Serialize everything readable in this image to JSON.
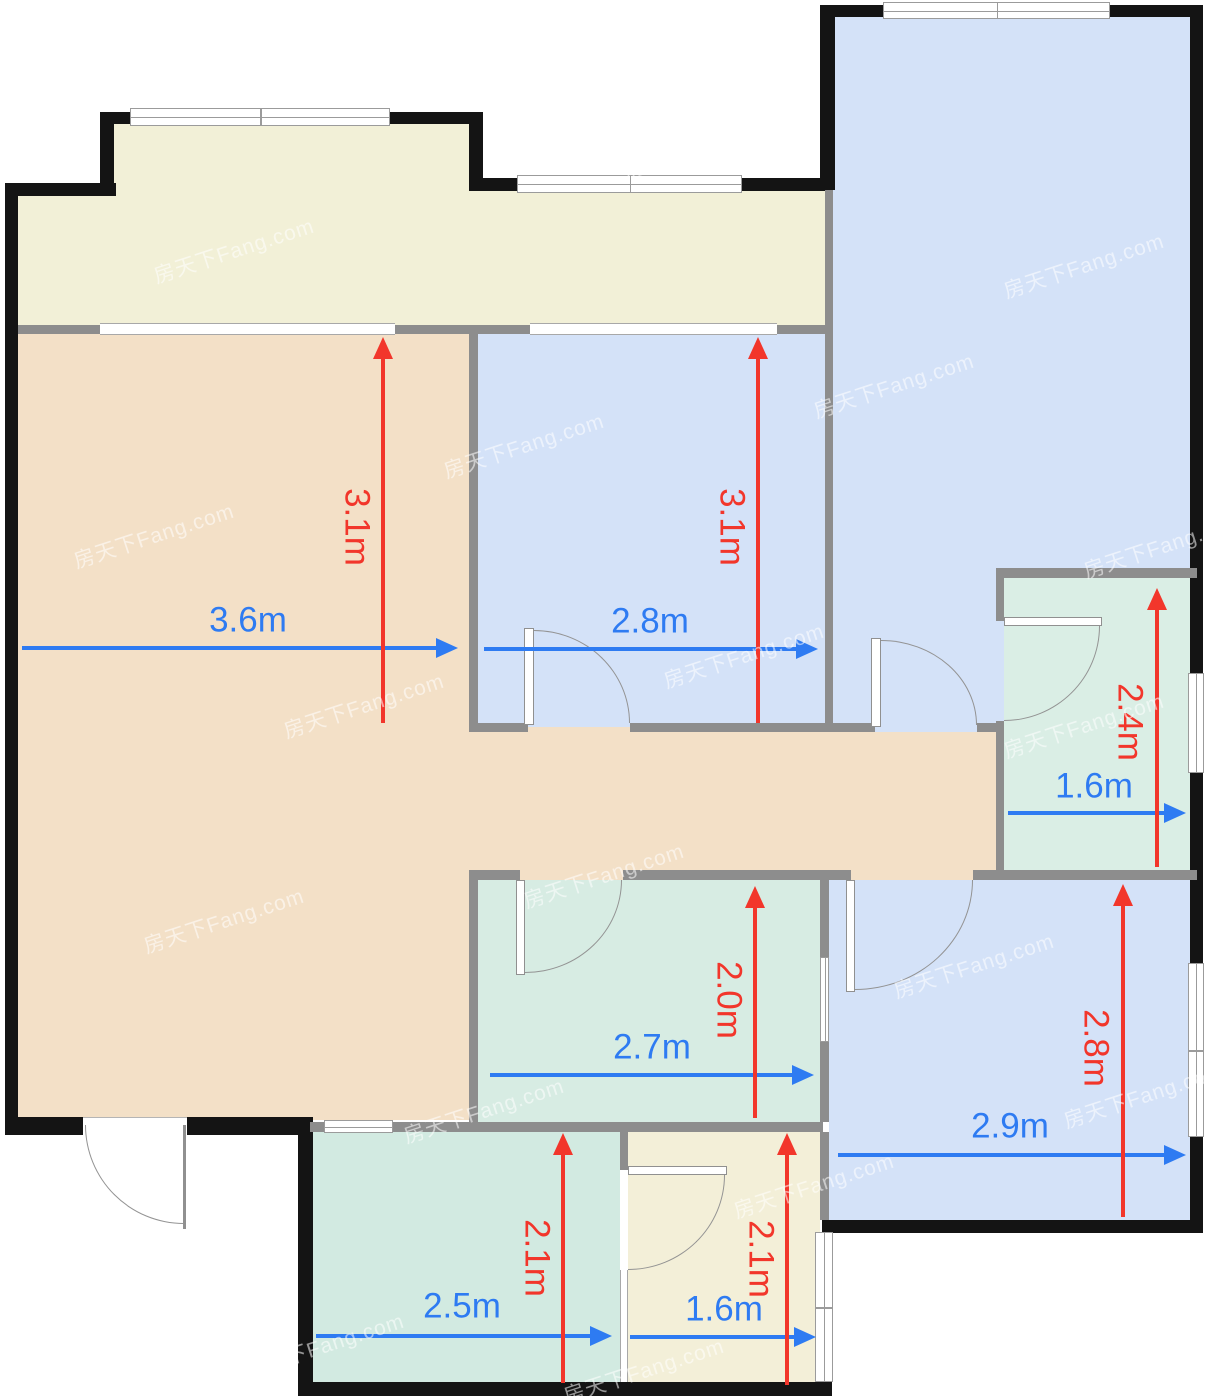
{
  "plan": {
    "canvas": {
      "width": 1208,
      "height": 1400
    },
    "colors": {
      "outer_wall": "#141414",
      "inner_wall": "#8d8d8d",
      "balcony": "#f2f0d7",
      "living": "#f3e0c7",
      "blue_room": "#d4e2f8",
      "green_room": "#d7ece3",
      "green_room_bottom": "#d2eae1",
      "bathroom_green": "#daeee5",
      "cream_room": "#f3efd8",
      "dim_red": "#f2362b",
      "dim_blue": "#2e7bf2"
    },
    "watermark": {
      "text": "房天下Fang.com"
    },
    "watermarks": [
      {
        "x": 150,
        "y": 235
      },
      {
        "x": 620,
        "y": 130
      },
      {
        "x": 1000,
        "y": 250
      },
      {
        "x": 70,
        "y": 520
      },
      {
        "x": 440,
        "y": 430
      },
      {
        "x": 810,
        "y": 370
      },
      {
        "x": 1080,
        "y": 530
      },
      {
        "x": 280,
        "y": 690
      },
      {
        "x": 660,
        "y": 640
      },
      {
        "x": 1000,
        "y": 710
      },
      {
        "x": 140,
        "y": 905
      },
      {
        "x": 520,
        "y": 860
      },
      {
        "x": 890,
        "y": 950
      },
      {
        "x": 1060,
        "y": 1080
      },
      {
        "x": 400,
        "y": 1095
      },
      {
        "x": 730,
        "y": 1170
      },
      {
        "x": 240,
        "y": 1330
      },
      {
        "x": 900,
        "y": 1320
      },
      {
        "x": 560,
        "y": 1355
      }
    ],
    "rooms": [
      {
        "name": "balcony-bump",
        "fill": "balcony",
        "x": 114,
        "y": 124,
        "w": 355,
        "h": 210
      },
      {
        "name": "balcony-main",
        "fill": "balcony",
        "x": 18,
        "y": 190,
        "w": 807,
        "h": 145
      },
      {
        "name": "living-room",
        "fill": "living",
        "x": 18,
        "y": 330,
        "w": 451,
        "h": 790
      },
      {
        "name": "corridor",
        "fill": "living",
        "x": 469,
        "y": 723,
        "w": 535,
        "h": 157
      },
      {
        "name": "bedroom-middle",
        "fill": "blue_room",
        "x": 478,
        "y": 334,
        "w": 347,
        "h": 393
      },
      {
        "name": "bedroom-large",
        "fill": "blue_room",
        "x": 833,
        "y": 17,
        "w": 357,
        "h": 715
      },
      {
        "name": "bathroom-right",
        "fill": "bathroom_green",
        "x": 1004,
        "y": 578,
        "w": 186,
        "h": 292
      },
      {
        "name": "room-green-middle",
        "fill": "green_room",
        "x": 478,
        "y": 880,
        "w": 342,
        "h": 242
      },
      {
        "name": "bedroom-bottom-right",
        "fill": "blue_room",
        "x": 829,
        "y": 880,
        "w": 361,
        "h": 340
      },
      {
        "name": "room-green-bottom",
        "fill": "green_room_bottom",
        "x": 313,
        "y": 1132,
        "w": 307,
        "h": 250
      },
      {
        "name": "bathroom-bottom",
        "fill": "cream_room",
        "x": 628,
        "y": 1132,
        "w": 192,
        "h": 250
      }
    ],
    "outer_walls": [
      {
        "x": 100,
        "y": 112,
        "w": 30,
        "h": 12
      },
      {
        "x": 390,
        "y": 112,
        "w": 93,
        "h": 12
      },
      {
        "x": 100,
        "y": 112,
        "w": 14,
        "h": 80
      },
      {
        "x": 469,
        "y": 112,
        "w": 14,
        "h": 78
      },
      {
        "x": 5,
        "y": 183,
        "w": 111,
        "h": 13
      },
      {
        "x": 469,
        "y": 178,
        "w": 48,
        "h": 13
      },
      {
        "x": 742,
        "y": 178,
        "w": 84,
        "h": 13
      },
      {
        "x": 5,
        "y": 183,
        "w": 13,
        "h": 952
      },
      {
        "x": 820,
        "y": 5,
        "w": 15,
        "h": 185
      },
      {
        "x": 820,
        "y": 5,
        "w": 63,
        "h": 12
      },
      {
        "x": 1110,
        "y": 5,
        "w": 93,
        "h": 12
      },
      {
        "x": 1190,
        "y": 5,
        "w": 13,
        "h": 555
      },
      {
        "x": 1190,
        "y": 560,
        "w": 13,
        "h": 113
      },
      {
        "x": 1190,
        "y": 773,
        "w": 13,
        "h": 190
      },
      {
        "x": 1190,
        "y": 1137,
        "w": 13,
        "h": 95
      },
      {
        "x": 822,
        "y": 1220,
        "w": 381,
        "h": 13
      },
      {
        "x": 298,
        "y": 1382,
        "w": 534,
        "h": 14
      },
      {
        "x": 298,
        "y": 1127,
        "w": 15,
        "h": 268
      },
      {
        "x": 5,
        "y": 1117,
        "w": 78,
        "h": 18
      },
      {
        "x": 187,
        "y": 1117,
        "w": 126,
        "h": 18
      }
    ],
    "inner_walls": [
      {
        "x": 18,
        "y": 325,
        "w": 82,
        "h": 9
      },
      {
        "x": 395,
        "y": 325,
        "w": 135,
        "h": 9
      },
      {
        "x": 777,
        "y": 325,
        "w": 48,
        "h": 9
      },
      {
        "x": 825,
        "y": 190,
        "w": 8,
        "h": 542
      },
      {
        "x": 469,
        "y": 334,
        "w": 9,
        "h": 389
      },
      {
        "x": 469,
        "y": 723,
        "w": 59,
        "h": 9
      },
      {
        "x": 630,
        "y": 723,
        "w": 195,
        "h": 9
      },
      {
        "x": 833,
        "y": 723,
        "w": 42,
        "h": 9
      },
      {
        "x": 977,
        "y": 723,
        "w": 27,
        "h": 9
      },
      {
        "x": 996,
        "y": 568,
        "w": 201,
        "h": 10
      },
      {
        "x": 996,
        "y": 578,
        "w": 8,
        "h": 43
      },
      {
        "x": 996,
        "y": 721,
        "w": 8,
        "h": 149
      },
      {
        "x": 469,
        "y": 870,
        "w": 51,
        "h": 10
      },
      {
        "x": 623,
        "y": 870,
        "w": 228,
        "h": 10
      },
      {
        "x": 973,
        "y": 870,
        "w": 224,
        "h": 10
      },
      {
        "x": 469,
        "y": 880,
        "w": 9,
        "h": 242
      },
      {
        "x": 820,
        "y": 880,
        "w": 9,
        "h": 77
      },
      {
        "x": 820,
        "y": 1042,
        "w": 9,
        "h": 80
      },
      {
        "x": 310,
        "y": 1122,
        "w": 14,
        "h": 10
      },
      {
        "x": 393,
        "y": 1122,
        "w": 76,
        "h": 10
      },
      {
        "x": 469,
        "y": 1122,
        "w": 354,
        "h": 10
      },
      {
        "x": 620,
        "y": 1132,
        "w": 8,
        "h": 38
      },
      {
        "x": 820,
        "y": 1132,
        "w": 9,
        "h": 88
      }
    ],
    "windows": [
      {
        "name": "balcony-bump-window",
        "x": 130,
        "y": 108,
        "w": 260,
        "h": 18,
        "orient": "h",
        "divider": true
      },
      {
        "name": "balcony-right-window",
        "x": 517,
        "y": 175,
        "w": 225,
        "h": 18,
        "orient": "h",
        "divider": true
      },
      {
        "name": "bedroom-large-top-window",
        "x": 883,
        "y": 2,
        "w": 227,
        "h": 17,
        "orient": "h",
        "divider": true
      },
      {
        "name": "bathroom-right-window",
        "x": 1188,
        "y": 673,
        "w": 16,
        "h": 100,
        "orient": "v",
        "divider": false
      },
      {
        "name": "bedroom-bottom-right-window",
        "x": 1188,
        "y": 963,
        "w": 16,
        "h": 174,
        "orient": "v",
        "divider": true
      },
      {
        "name": "bathroom-bottom-right-window",
        "x": 815,
        "y": 1232,
        "w": 18,
        "h": 150,
        "orient": "v",
        "divider": true
      },
      {
        "name": "room-green-bottom-window",
        "x": 324,
        "y": 1120,
        "w": 69,
        "h": 13,
        "orient": "h",
        "divider": false
      },
      {
        "name": "room-green-middle-window",
        "x": 820,
        "y": 957,
        "w": 9,
        "h": 85,
        "orient": "v",
        "divider": false
      }
    ],
    "openings": [
      {
        "name": "living-balcony-slider",
        "x": 100,
        "y": 323,
        "w": 295,
        "h": 12
      },
      {
        "name": "bedroom-balcony-slider",
        "x": 530,
        "y": 323,
        "w": 247,
        "h": 12
      },
      {
        "name": "bathroom-bottom-left-window",
        "x": 620,
        "y": 1270,
        "w": 8,
        "h": 112
      }
    ],
    "doors": [
      {
        "name": "door-bedroom-middle",
        "leaf": {
          "x": 524,
          "y": 628,
          "w": 10,
          "h": 97
        },
        "arc": {
          "x": 534,
          "y": 630,
          "w": 96,
          "h": 93,
          "corner": "tr"
        }
      },
      {
        "name": "door-bedroom-large",
        "leaf": {
          "x": 871,
          "y": 638,
          "w": 10,
          "h": 89
        },
        "arc": {
          "x": 881,
          "y": 640,
          "w": 96,
          "h": 85,
          "corner": "tr"
        }
      },
      {
        "name": "door-room-green-middle",
        "leaf": {
          "x": 516,
          "y": 880,
          "w": 9,
          "h": 95
        },
        "arc": {
          "x": 525,
          "y": 880,
          "w": 97,
          "h": 93,
          "corner": "br"
        }
      },
      {
        "name": "door-bedroom-bottom-right",
        "leaf": {
          "x": 846,
          "y": 880,
          "w": 9,
          "h": 112
        },
        "arc": {
          "x": 855,
          "y": 880,
          "w": 118,
          "h": 110,
          "corner": "br"
        }
      },
      {
        "name": "door-bathroom-right",
        "leaf": {
          "x": 1004,
          "y": 617,
          "w": 98,
          "h": 9
        },
        "arc": {
          "x": 1004,
          "y": 626,
          "w": 96,
          "h": 95,
          "corner": "br"
        }
      },
      {
        "name": "door-bathroom-bottom",
        "leaf": {
          "x": 628,
          "y": 1166,
          "w": 99,
          "h": 9
        },
        "arc": {
          "x": 628,
          "y": 1175,
          "w": 97,
          "h": 95,
          "corner": "br"
        }
      }
    ],
    "entrance_door": {
      "name": "entrance-door",
      "gap": {
        "x": 83,
        "y": 1117,
        "w": 104,
        "h": 18
      },
      "leaf": {
        "x": 183,
        "y": 1125,
        "w": 3,
        "h": 104
      },
      "arc": {
        "x": 85,
        "y": 1125,
        "w": 99,
        "h": 99,
        "corner": "bl"
      }
    },
    "dimensions": [
      {
        "name": "dim-living-width",
        "label": "3.6m",
        "type": "h",
        "color": "blue",
        "x": 22,
        "y": 648,
        "len": 436,
        "labelX": 248,
        "labelY": 620
      },
      {
        "name": "dim-bedroom-middle-width",
        "label": "2.8m",
        "type": "h",
        "color": "blue",
        "x": 484,
        "y": 649,
        "len": 334,
        "labelX": 650,
        "labelY": 621
      },
      {
        "name": "dim-bathroom-right-width",
        "label": "1.6m",
        "type": "h",
        "color": "blue",
        "x": 1008,
        "y": 813,
        "len": 178,
        "labelX": 1094,
        "labelY": 786
      },
      {
        "name": "dim-room-green-middle-width",
        "label": "2.7m",
        "type": "h",
        "color": "blue",
        "x": 490,
        "y": 1075,
        "len": 324,
        "labelX": 652,
        "labelY": 1047
      },
      {
        "name": "dim-bedroom-bottom-right-width",
        "label": "2.9m",
        "type": "h",
        "color": "blue",
        "x": 838,
        "y": 1155,
        "len": 348,
        "labelX": 1010,
        "labelY": 1126
      },
      {
        "name": "dim-room-green-bottom-width",
        "label": "2.5m",
        "type": "h",
        "color": "blue",
        "x": 316,
        "y": 1336,
        "len": 296,
        "labelX": 462,
        "labelY": 1306
      },
      {
        "name": "dim-bathroom-bottom-width",
        "label": "1.6m",
        "type": "h",
        "color": "blue",
        "x": 630,
        "y": 1337,
        "len": 186,
        "labelX": 724,
        "labelY": 1309
      },
      {
        "name": "dim-living-height",
        "label": "3.1m",
        "type": "v",
        "color": "red",
        "x": 383,
        "y": 337,
        "len": 386,
        "labelX": 357,
        "labelY": 527
      },
      {
        "name": "dim-bedroom-middle-height",
        "label": "3.1m",
        "type": "v",
        "color": "red",
        "x": 758,
        "y": 337,
        "len": 386,
        "labelX": 732,
        "labelY": 527
      },
      {
        "name": "dim-bathroom-right-height",
        "label": "2.4m",
        "type": "v",
        "color": "red",
        "x": 1157,
        "y": 588,
        "len": 279,
        "labelX": 1130,
        "labelY": 722
      },
      {
        "name": "dim-room-green-middle-height",
        "label": "2.0m",
        "type": "v",
        "color": "red",
        "x": 755,
        "y": 886,
        "len": 232,
        "labelX": 729,
        "labelY": 1000
      },
      {
        "name": "dim-bedroom-bottom-right-height",
        "label": "2.8m",
        "type": "v",
        "color": "red",
        "x": 1123,
        "y": 884,
        "len": 333,
        "labelX": 1096,
        "labelY": 1048
      },
      {
        "name": "dim-room-green-bottom-height",
        "label": "2.1m",
        "type": "v",
        "color": "red",
        "x": 563,
        "y": 1133,
        "len": 250,
        "labelX": 537,
        "labelY": 1258
      },
      {
        "name": "dim-bathroom-bottom-height",
        "label": "2.1m",
        "type": "v",
        "color": "red",
        "x": 787,
        "y": 1133,
        "len": 252,
        "labelX": 761,
        "labelY": 1259
      }
    ]
  }
}
